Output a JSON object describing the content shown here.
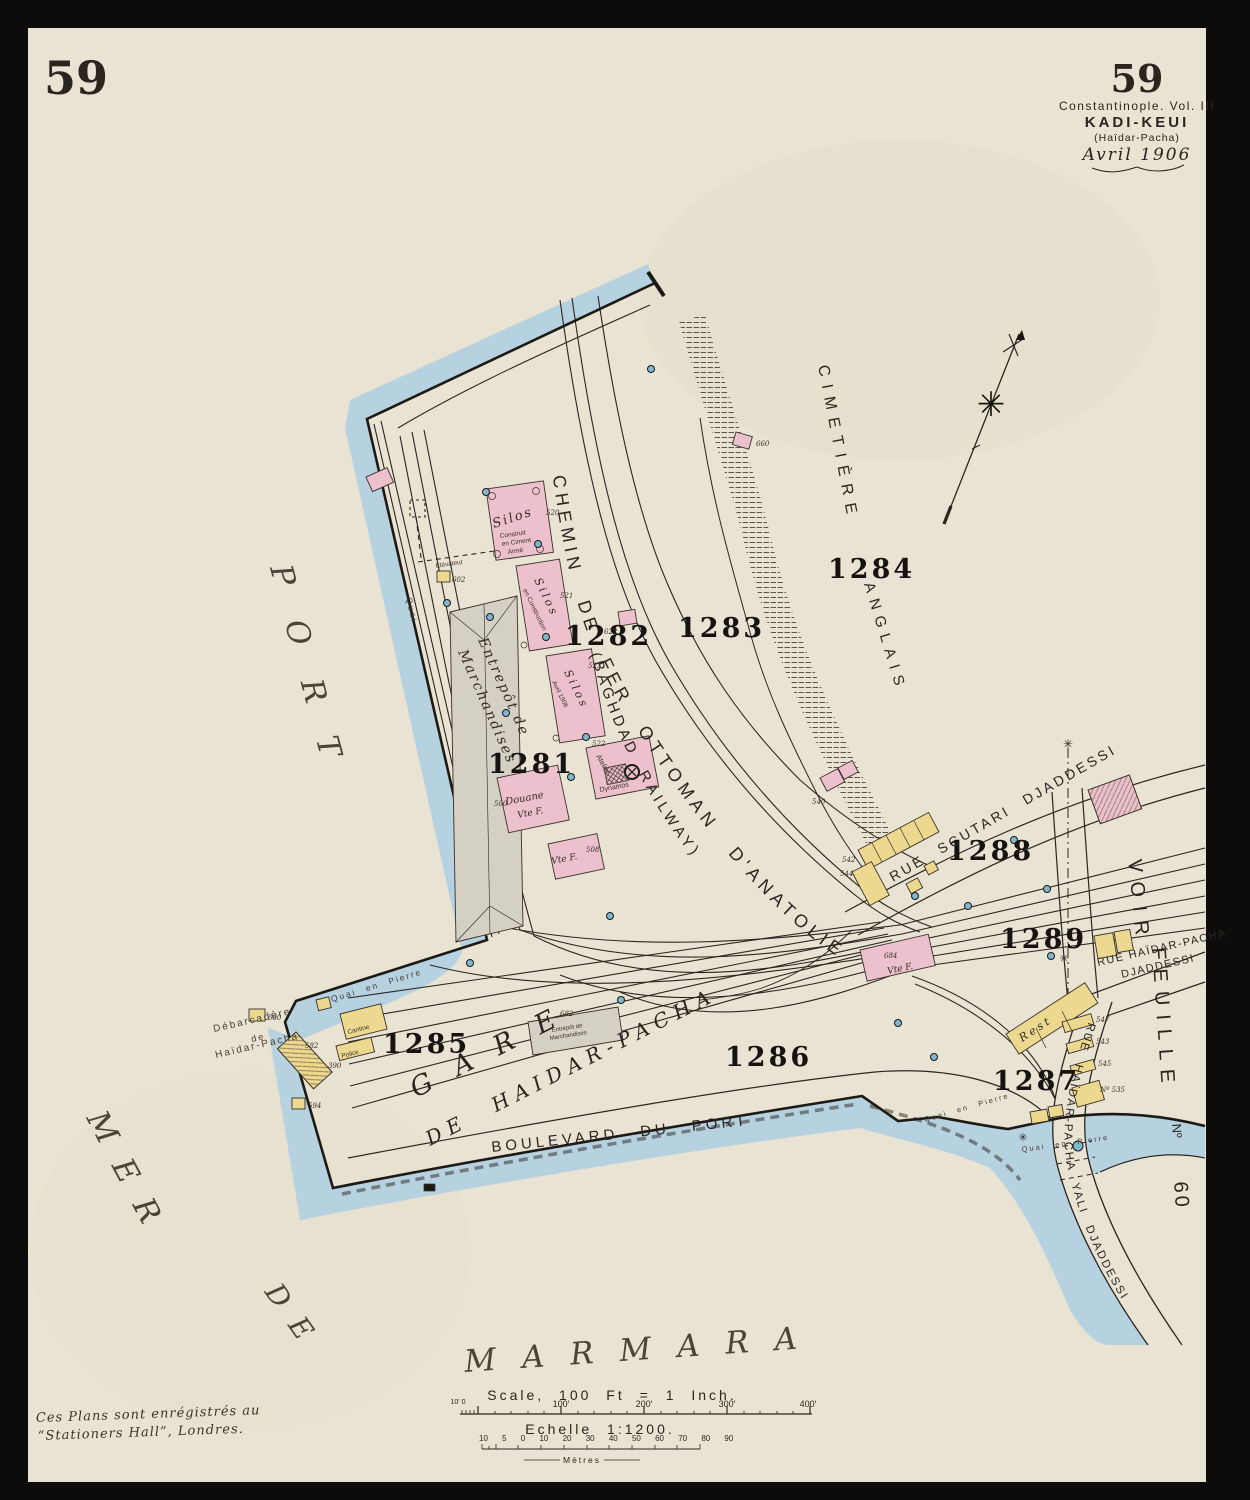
{
  "page": {
    "sheet_left": "59",
    "sheet_right": "59",
    "title1": "Constantinople. Vol. III",
    "title2": "KADI-KEUI",
    "title3": "(Haïdar-Pacha)",
    "title4": "Avril 1906",
    "reg1": "Ces Plans sont enrégistrés au",
    "reg2": "“Stationers Hall”, Londres."
  },
  "scalebar": {
    "english": "Scale, 100 Ft = 1 Inch.",
    "feet0": "10′ 0",
    "ft100": "100′",
    "ft200": "200′",
    "ft300": "300′",
    "ft400": "400′",
    "french": "Echelle 1:1200.",
    "metric_row": "10 5 0 10 20 30 40 50 60 70 80 90",
    "metres": "Mètres"
  },
  "water": {
    "port": "PORT",
    "mer": "MER",
    "de": "DE",
    "marmara": "MARMARA"
  },
  "blocks": {
    "b1281": "1281",
    "b1282": "1282",
    "b1283": "1283",
    "b1284": "1284",
    "b1285": "1285",
    "b1286": "1286",
    "b1287": "1287",
    "b1288": "1288",
    "b1289": "1289"
  },
  "railway": {
    "main": "CHEMIN DE FER OTTOMAN D'ANATOLIE",
    "baghdad": "(BAGHDAD RAILWAY)"
  },
  "streets": {
    "boulevard": "BOULEVARD DU PORT",
    "gare1": "GARE",
    "gare2": "DE HAIDAR-PACHA",
    "scutari": "RUE SCUTARI DJADDESSI",
    "haidar_top1": "RUE HAÏDAR-PACHA",
    "haidar_top2": "DJADDESSI",
    "yali": "RUE HAÏDAR-PACHA YALI DJADDESSI"
  },
  "features": {
    "cimetiere": "CIMETIÈRE",
    "anglais": "ANGLAIS",
    "voir": "VOIR",
    "feuille": "FEUILLE",
    "no": "Nº",
    "sixty": "60",
    "debar1": "Débarcadère",
    "debar2": "de",
    "debar3": "Haïdar-Pacha",
    "quai": "Quai",
    "quai_en_pierre": "Quai en Pierre"
  },
  "buildings": {
    "silos": "Silos",
    "construit": "Construit",
    "ciment": "en Ciment",
    "arme": "Armé",
    "en_construction": "en Construction",
    "avril": "Avril 1906",
    "entrepot1": "Entrepôt de",
    "entrepot2": "Marchandises",
    "douane": "Douane",
    "vte_f": "Vte F.",
    "atelier": "Atelier",
    "dynamos": "Dynamos",
    "elevateur": "Élévateur",
    "cantine": "Cantine",
    "police": "Police",
    "rest": "Rest"
  },
  "numbers": {
    "n500": "500",
    "n508": "508",
    "n520": "520",
    "n521": "521",
    "n522": "522",
    "n523": "523",
    "n535": "Nº 535",
    "n540": "540",
    "n542": "542",
    "n543": "543",
    "n544": "544",
    "n545": "545",
    "n547": "547",
    "n580": "580",
    "n582": "582",
    "n390": "390",
    "n594": "594",
    "n602": "602",
    "n622": "622",
    "n660": "660",
    "n682": "682",
    "n684": "684"
  }
}
